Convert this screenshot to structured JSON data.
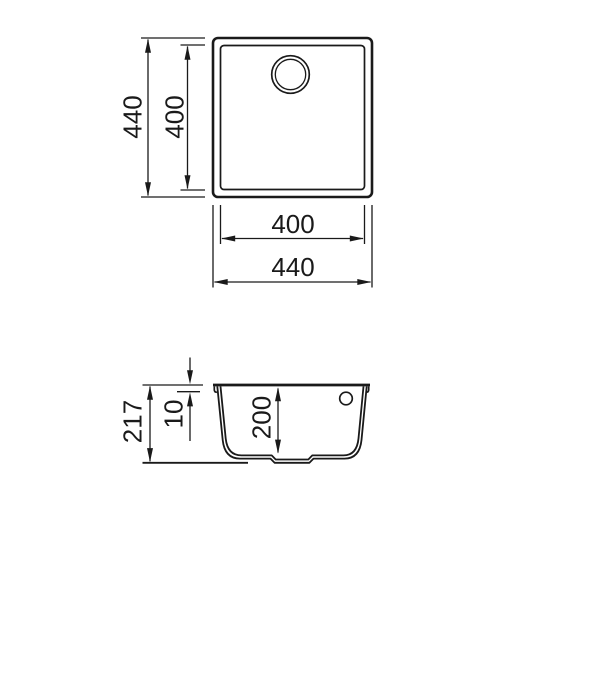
{
  "colors": {
    "line": "#1a1a1a",
    "background": "#ffffff"
  },
  "top_view": {
    "outer_height_label": "440",
    "inner_height_label": "400",
    "inner_width_label": "400",
    "outer_width_label": "440"
  },
  "section_view": {
    "total_depth_label": "217",
    "rim_thickness_label": "10",
    "bowl_depth_label": "200"
  }
}
